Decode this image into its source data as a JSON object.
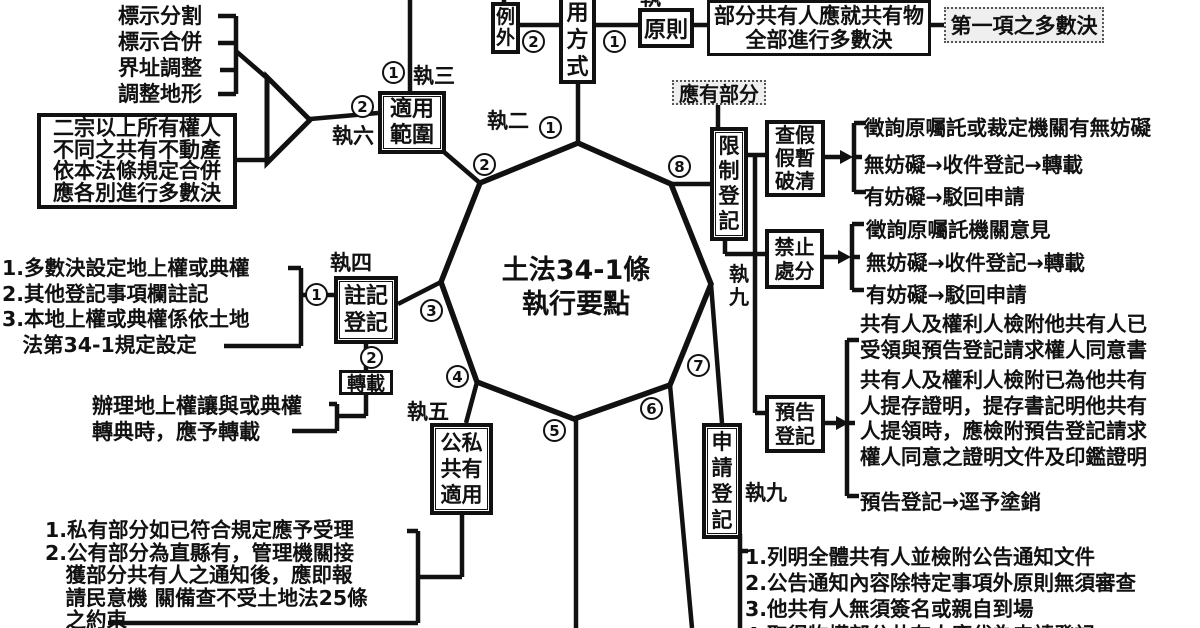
{
  "title": "土法34-1條\n執行要點",
  "colors": {
    "ink": "#111111",
    "dotted_box_bg": "#efefef"
  },
  "top_left_items": [
    "標示分割",
    "標示合併",
    "界址調整",
    "調整地形"
  ],
  "boxes": {
    "merge_rule": "二宗以上所有權人\n不同之共有不動產\n依本法條規定合併\n應各別進行多數決",
    "scope": "適用\n範圍",
    "exception": "例\n外",
    "usage_method": "適\n用\n方\n式",
    "principle": "原則",
    "majority_on_whole": "部分共有人應就共有物\n全部進行多數決",
    "first_item_majority": "第一項之多數決",
    "share_portion": "應有部分",
    "restricted_registration": "限\n制\n登\n記",
    "seizure_types": "查假\n假暫\n破清",
    "prohibit_disposal": "禁止\n處分",
    "advance_notice_registration": "預告\n登記",
    "annotation_registration": "註記\n登記",
    "transcribe": "轉載",
    "public_private_coownership": "公私\n共有\n適用",
    "application_registration": "申\n請\n登\n記"
  },
  "exec_point_labels": {
    "zhi1": "執",
    "zhi2": "執二",
    "zhi3": "執三",
    "zhi4": "執四",
    "zhi5": "執五",
    "zhi6": "執六",
    "zhi9_vertical": "執\n九",
    "zhi9_horizontal": "執九"
  },
  "circled_numbers": {
    "scope_top": "1",
    "exception_link": "2",
    "principle_link": "1",
    "merge_link": "2",
    "annotation_link": "1",
    "transcribe_link": "2",
    "octagon": [
      "1",
      "2",
      "3",
      "4",
      "5",
      "6",
      "7",
      "8"
    ]
  },
  "notes": {
    "annotation_list": "1.多數決設定地上權或典權\n2.其他登記事項欄註記\n3.本地上權或典權係依土地\n　法第34-1規定設定",
    "transcribe_caption": "辦理地上權讓與或典權\n轉典時，應予轉載",
    "public_private_list": "1.私有部分如已符合規定應予受理\n2.公有部分為直縣有，管理機關接\n　獲部分共有人之通知後，應即報\n　請民意機 關備查不受土地法25條\n　之約束",
    "application_list": "1.列明全體共有人並檢附公告通知文件\n2.公告通知內容除特定事項外原則無須審查\n3.他共有人無須簽名或親自到場\n4.取得物權部分共有人應代為申請登記"
  },
  "branches": {
    "seizure": [
      "徵詢原囑託或裁定機關有無妨礙",
      "無妨礙→收件登記→轉載",
      "有妨礙→駁回申請"
    ],
    "prohibit": [
      "徵詢原囑託機關意見",
      "無妨礙→收件登記→轉載",
      "有妨礙→駁回申請"
    ],
    "advance_notice": [
      "共有人及權利人檢附他共有人已\n受領與預告登記請求權人同意書",
      "共有人及權利人檢附已為他共有\n人提存證明，提存書記明他共有\n人提領時，應檢附預告登記請求\n權人同意之證明文件及印鑑證明",
      "預告登記→逕予塗銷"
    ]
  }
}
